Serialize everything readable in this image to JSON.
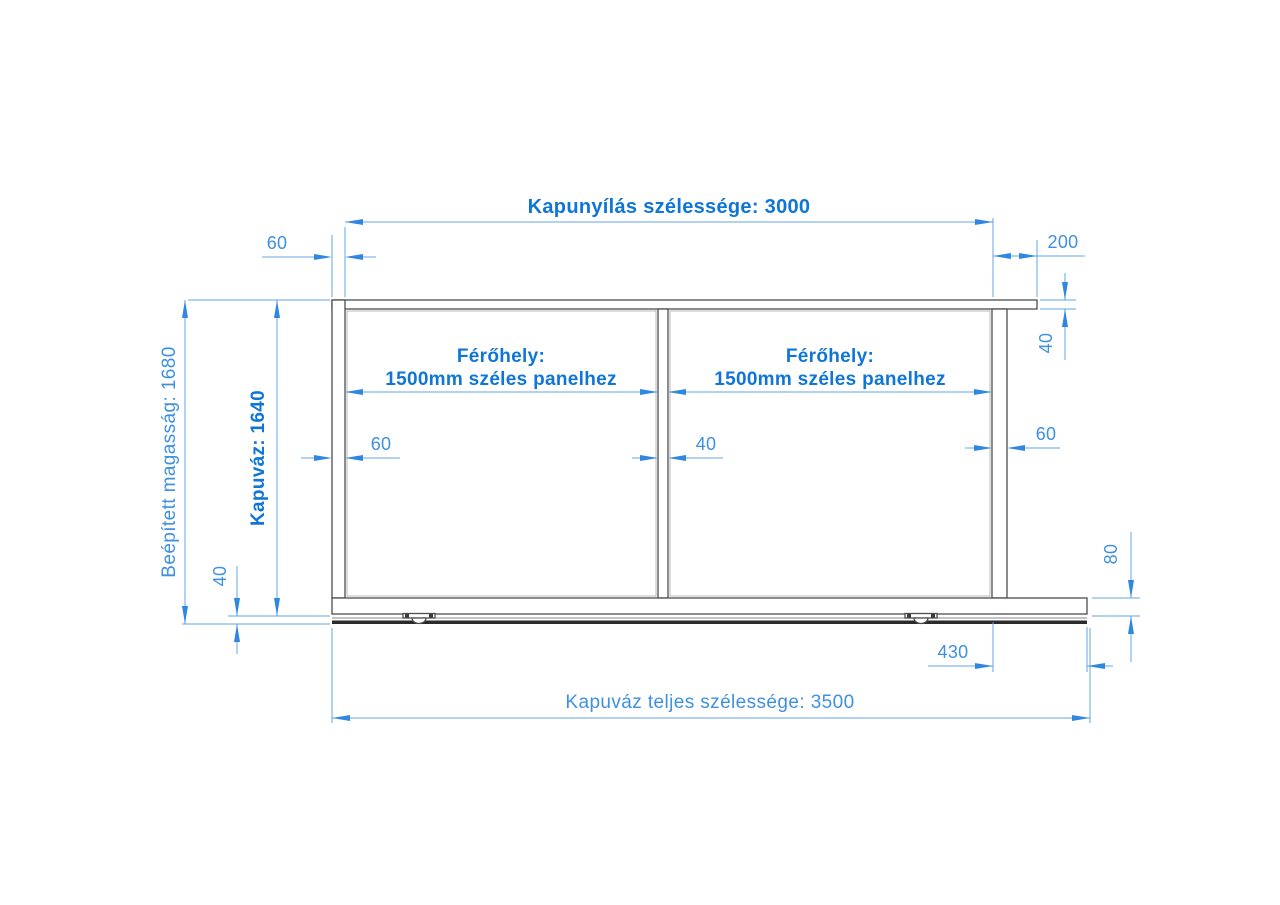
{
  "drawing": {
    "type": "technical-dimension-drawing",
    "subject": "sliding gate frame front elevation",
    "language": "hu",
    "unit": "mm",
    "colors": {
      "dimension_blue": "#2f87e2",
      "label_blue_strong": "#0f76d8",
      "label_blue_regular": "#3e90e2",
      "structure_gray": "#4d4d4d",
      "track_dark": "#2b2b2b",
      "background": "#ffffff"
    },
    "panels": [
      {
        "title": "Férőhely:",
        "subtitle": "1500mm széles panelhez",
        "value_mm": 1500
      },
      {
        "title": "Férőhely:",
        "subtitle": "1500mm széles panelhez",
        "value_mm": 1500
      }
    ],
    "dimensions": [
      {
        "name": "opening-width",
        "label": "Kapunyílás szélessége: 3000",
        "value_mm": 3000,
        "orientation": "horizontal"
      },
      {
        "name": "left-post-width-top",
        "label": "60",
        "value_mm": 60,
        "orientation": "horizontal"
      },
      {
        "name": "right-top-overhang",
        "label": "200",
        "value_mm": 200,
        "orientation": "horizontal"
      },
      {
        "name": "top-rail-height",
        "label": "40",
        "value_mm": 40,
        "orientation": "vertical"
      },
      {
        "name": "installed-height",
        "label": "Beépített magasság: 1680",
        "value_mm": 1680,
        "orientation": "vertical"
      },
      {
        "name": "frame-height",
        "label": "Kapuváz: 1640",
        "value_mm": 1640,
        "orientation": "vertical"
      },
      {
        "name": "left-post-width",
        "label": "60",
        "value_mm": 60,
        "orientation": "horizontal"
      },
      {
        "name": "middle-post-width",
        "label": "40",
        "value_mm": 40,
        "orientation": "horizontal"
      },
      {
        "name": "right-post-width",
        "label": "60",
        "value_mm": 60,
        "orientation": "horizontal"
      },
      {
        "name": "track-height",
        "label": "40",
        "value_mm": 40,
        "orientation": "vertical"
      },
      {
        "name": "bottom-rail-height",
        "label": "80",
        "value_mm": 80,
        "orientation": "vertical"
      },
      {
        "name": "base-overhang-right",
        "label": "430",
        "value_mm": 430,
        "orientation": "horizontal"
      },
      {
        "name": "total-width",
        "label": "Kapuváz teljes szélessége: 3500",
        "value_mm": 3500,
        "orientation": "horizontal"
      }
    ]
  }
}
